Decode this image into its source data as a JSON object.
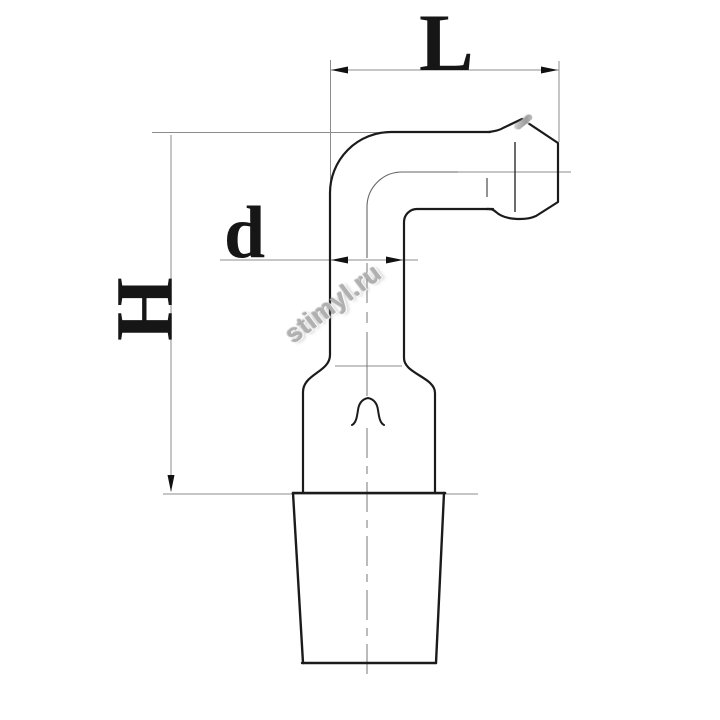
{
  "dimensions": {
    "width_label": "L",
    "diameter_label": "d",
    "height_label": "H"
  },
  "watermark": {
    "text": "stimyl.ru"
  },
  "colors": {
    "outline": "#1b1b1b",
    "thin_line": "#8c8c8c",
    "centerline": "#777777",
    "arrow": "#111111",
    "watermark": "#b0b0b0",
    "background": "#ffffff"
  }
}
